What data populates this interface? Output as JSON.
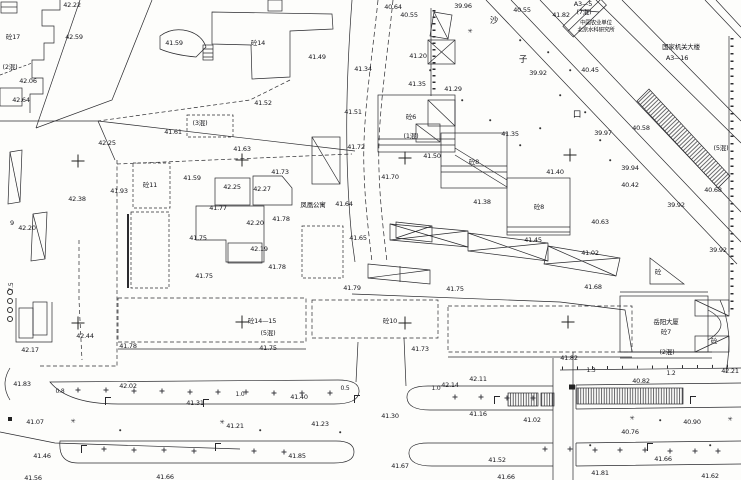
{
  "map": {
    "type": "cadastral-survey-site-plan",
    "colors": {
      "background": "#fdfdfb",
      "line": "#2a2a2e",
      "text": "#17171c"
    },
    "road_name_chars": [
      {
        "t": "沙",
        "x": 494,
        "y": 21
      },
      {
        "t": "子",
        "x": 523,
        "y": 60
      },
      {
        "t": "口",
        "x": 577,
        "y": 115
      }
    ],
    "place_labels": [
      {
        "t": "中国农业单位",
        "x": 596,
        "y": 24,
        "s": 5.5
      },
      {
        "t": "北京水科研究所",
        "x": 596,
        "y": 31,
        "s": 5.5
      },
      {
        "t": "国家机关大楼",
        "x": 681,
        "y": 47
      },
      {
        "t": "A3—16",
        "x": 677,
        "y": 58
      },
      {
        "t": "凤凰公寓",
        "x": 313,
        "y": 205
      },
      {
        "t": "岳阳大厦",
        "x": 666,
        "y": 322
      }
    ],
    "building_labels": [
      {
        "t": "砼17",
        "x": 13,
        "y": 37
      },
      {
        "t": "砼14",
        "x": 258,
        "y": 43
      },
      {
        "t": "A3—5",
        "x": 583,
        "y": 4
      },
      {
        "t": "(7混)",
        "x": 584,
        "y": 12
      },
      {
        "t": "(2混)",
        "x": 10,
        "y": 67
      },
      {
        "t": "(3混)",
        "x": 200,
        "y": 123
      },
      {
        "t": "砼6",
        "x": 411,
        "y": 117
      },
      {
        "t": "(1混)",
        "x": 411,
        "y": 136
      },
      {
        "t": "砼8",
        "x": 474,
        "y": 162
      },
      {
        "t": "砼8",
        "x": 539,
        "y": 207
      },
      {
        "t": "砼11",
        "x": 150,
        "y": 185
      },
      {
        "t": "(5混)",
        "x": 721,
        "y": 148
      },
      {
        "t": "砼14—15",
        "x": 262,
        "y": 321
      },
      {
        "t": "(5混)",
        "x": 268,
        "y": 333
      },
      {
        "t": "砼10",
        "x": 390,
        "y": 321
      },
      {
        "t": "砼7",
        "x": 666,
        "y": 332
      },
      {
        "t": "(2混)",
        "x": 667,
        "y": 352
      },
      {
        "t": "砼",
        "x": 658,
        "y": 272
      },
      {
        "t": "砼",
        "x": 714,
        "y": 341
      },
      {
        "t": "9",
        "x": 12,
        "y": 223
      }
    ],
    "dimension_labels": [
      {
        "t": "0.8",
        "x": 60,
        "y": 392
      },
      {
        "t": "1.0",
        "x": 240,
        "y": 395
      },
      {
        "t": "0.5",
        "x": 345,
        "y": 389
      },
      {
        "t": "1.0",
        "x": 436,
        "y": 389
      },
      {
        "t": "1.3",
        "x": 591,
        "y": 371
      },
      {
        "t": "1.2",
        "x": 671,
        "y": 374
      },
      {
        "t": "7.5",
        "x": 12,
        "y": 287,
        "rot": -90
      }
    ],
    "elevation_labels": [
      {
        "t": "42.22",
        "x": 72,
        "y": 5
      },
      {
        "t": "40.64",
        "x": 393,
        "y": 7
      },
      {
        "t": "39.96",
        "x": 463,
        "y": 6
      },
      {
        "t": "40.55",
        "x": 409,
        "y": 15
      },
      {
        "t": "40.55",
        "x": 522,
        "y": 10
      },
      {
        "t": "41.82",
        "x": 561,
        "y": 15
      },
      {
        "t": "42.59",
        "x": 74,
        "y": 37
      },
      {
        "t": "41.59",
        "x": 174,
        "y": 43
      },
      {
        "t": "41.49",
        "x": 317,
        "y": 57
      },
      {
        "t": "41.20",
        "x": 418,
        "y": 56
      },
      {
        "t": "39.92",
        "x": 538,
        "y": 73
      },
      {
        "t": "40.45",
        "x": 590,
        "y": 70
      },
      {
        "t": "41.34",
        "x": 363,
        "y": 69
      },
      {
        "t": "42.06",
        "x": 28,
        "y": 81
      },
      {
        "t": "41.35",
        "x": 417,
        "y": 84
      },
      {
        "t": "41.29",
        "x": 453,
        "y": 89
      },
      {
        "t": "42.64",
        "x": 21,
        "y": 100
      },
      {
        "t": "41.52",
        "x": 263,
        "y": 103
      },
      {
        "t": "41.51",
        "x": 353,
        "y": 112
      },
      {
        "t": "41.35",
        "x": 510,
        "y": 134
      },
      {
        "t": "40.58",
        "x": 641,
        "y": 128
      },
      {
        "t": "39.97",
        "x": 603,
        "y": 133
      },
      {
        "t": "41.61",
        "x": 173,
        "y": 132
      },
      {
        "t": "42.25",
        "x": 107,
        "y": 143
      },
      {
        "t": "41.72",
        "x": 356,
        "y": 147
      },
      {
        "t": "41.50",
        "x": 432,
        "y": 156
      },
      {
        "t": "41.63",
        "x": 242,
        "y": 149
      },
      {
        "t": "41.40",
        "x": 555,
        "y": 172
      },
      {
        "t": "41.59",
        "x": 192,
        "y": 178
      },
      {
        "t": "42.25",
        "x": 232,
        "y": 187
      },
      {
        "t": "42.27",
        "x": 262,
        "y": 189
      },
      {
        "t": "41.73",
        "x": 280,
        "y": 172
      },
      {
        "t": "41.70",
        "x": 390,
        "y": 177
      },
      {
        "t": "39.94",
        "x": 630,
        "y": 168
      },
      {
        "t": "40.42",
        "x": 630,
        "y": 185
      },
      {
        "t": "40.68",
        "x": 713,
        "y": 190
      },
      {
        "t": "39.92",
        "x": 676,
        "y": 205
      },
      {
        "t": "41.93",
        "x": 119,
        "y": 191
      },
      {
        "t": "41.77",
        "x": 218,
        "y": 208
      },
      {
        "t": "42.20",
        "x": 255,
        "y": 223
      },
      {
        "t": "41.78",
        "x": 281,
        "y": 219
      },
      {
        "t": "42.38",
        "x": 77,
        "y": 199
      },
      {
        "t": "41.64",
        "x": 344,
        "y": 204
      },
      {
        "t": "41.38",
        "x": 482,
        "y": 202
      },
      {
        "t": "40.63",
        "x": 600,
        "y": 222
      },
      {
        "t": "42.20",
        "x": 27,
        "y": 228
      },
      {
        "t": "41.75",
        "x": 198,
        "y": 238
      },
      {
        "t": "41.65",
        "x": 358,
        "y": 238
      },
      {
        "t": "41.45",
        "x": 533,
        "y": 240
      },
      {
        "t": "42.19",
        "x": 259,
        "y": 249
      },
      {
        "t": "41.78",
        "x": 277,
        "y": 267
      },
      {
        "t": "39.92",
        "x": 718,
        "y": 250
      },
      {
        "t": "41.02",
        "x": 590,
        "y": 253
      },
      {
        "t": "41.75",
        "x": 204,
        "y": 276
      },
      {
        "t": "41.79",
        "x": 352,
        "y": 288
      },
      {
        "t": "41.75",
        "x": 455,
        "y": 289
      },
      {
        "t": "41.68",
        "x": 593,
        "y": 287
      },
      {
        "t": "41.75",
        "x": 268,
        "y": 348
      },
      {
        "t": "41.73",
        "x": 420,
        "y": 349
      },
      {
        "t": "41.82",
        "x": 569,
        "y": 358
      },
      {
        "t": "42.17",
        "x": 30,
        "y": 350
      },
      {
        "t": "42.44",
        "x": 85,
        "y": 336
      },
      {
        "t": "41.78",
        "x": 128,
        "y": 346
      },
      {
        "t": "41.83",
        "x": 22,
        "y": 384
      },
      {
        "t": "42.02",
        "x": 128,
        "y": 386
      },
      {
        "t": "42.14",
        "x": 450,
        "y": 385
      },
      {
        "t": "42.11",
        "x": 478,
        "y": 379
      },
      {
        "t": "42.21",
        "x": 730,
        "y": 371
      },
      {
        "t": "40.82",
        "x": 641,
        "y": 381
      },
      {
        "t": "41.31",
        "x": 195,
        "y": 403
      },
      {
        "t": "41.40",
        "x": 299,
        "y": 397
      },
      {
        "t": "41.30",
        "x": 390,
        "y": 416
      },
      {
        "t": "41.07",
        "x": 35,
        "y": 422
      },
      {
        "t": "41.21",
        "x": 235,
        "y": 426
      },
      {
        "t": "41.23",
        "x": 320,
        "y": 424
      },
      {
        "t": "41.16",
        "x": 478,
        "y": 414
      },
      {
        "t": "41.02",
        "x": 532,
        "y": 420
      },
      {
        "t": "40.90",
        "x": 692,
        "y": 422
      },
      {
        "t": "40.76",
        "x": 630,
        "y": 432
      },
      {
        "t": "41.46",
        "x": 42,
        "y": 456
      },
      {
        "t": "41.52",
        "x": 497,
        "y": 460
      },
      {
        "t": "41.66",
        "x": 663,
        "y": 459
      },
      {
        "t": "41.85",
        "x": 297,
        "y": 456
      },
      {
        "t": "41.67",
        "x": 400,
        "y": 466
      },
      {
        "t": "41.56",
        "x": 33,
        "y": 478
      },
      {
        "t": "41.66",
        "x": 165,
        "y": 477
      },
      {
        "t": "41.66",
        "x": 506,
        "y": 477
      },
      {
        "t": "41.81",
        "x": 600,
        "y": 473
      },
      {
        "t": "41.62",
        "x": 710,
        "y": 476
      }
    ],
    "grid_crosses": [
      {
        "x": 78,
        "y": 161
      },
      {
        "x": 242,
        "y": 160
      },
      {
        "x": 405,
        "y": 158
      },
      {
        "x": 570,
        "y": 155
      },
      {
        "x": 78,
        "y": 323
      },
      {
        "x": 242,
        "y": 322
      },
      {
        "x": 405,
        "y": 323
      },
      {
        "x": 568,
        "y": 322
      }
    ],
    "symbols": {
      "lamps": [
        {
          "x": 108,
          "y": 401
        },
        {
          "x": 206,
          "y": 403
        },
        {
          "x": 357,
          "y": 399
        },
        {
          "x": 497,
          "y": 400
        },
        {
          "x": 693,
          "y": 400
        },
        {
          "x": 84,
          "y": 449
        },
        {
          "x": 218,
          "y": 447
        },
        {
          "x": 650,
          "y": 447
        }
      ],
      "tree_plus": [
        {
          "x": 78,
          "y": 390
        },
        {
          "x": 106,
          "y": 390
        },
        {
          "x": 134,
          "y": 391
        },
        {
          "x": 162,
          "y": 391
        },
        {
          "x": 190,
          "y": 392
        },
        {
          "x": 218,
          "y": 392
        },
        {
          "x": 246,
          "y": 392
        },
        {
          "x": 274,
          "y": 393
        },
        {
          "x": 302,
          "y": 393
        },
        {
          "x": 330,
          "y": 393
        },
        {
          "x": 455,
          "y": 397
        },
        {
          "x": 481,
          "y": 397
        },
        {
          "x": 507,
          "y": 398
        },
        {
          "x": 533,
          "y": 398
        },
        {
          "x": 104,
          "y": 449
        },
        {
          "x": 134,
          "y": 450
        },
        {
          "x": 164,
          "y": 450
        },
        {
          "x": 194,
          "y": 451
        },
        {
          "x": 254,
          "y": 451
        },
        {
          "x": 284,
          "y": 452
        },
        {
          "x": 545,
          "y": 449
        },
        {
          "x": 570,
          "y": 449
        },
        {
          "x": 595,
          "y": 450
        },
        {
          "x": 620,
          "y": 450
        },
        {
          "x": 645,
          "y": 450
        },
        {
          "x": 670,
          "y": 451
        },
        {
          "x": 695,
          "y": 451
        },
        {
          "x": 718,
          "y": 451
        }
      ],
      "tree_star": [
        {
          "x": 73,
          "y": 422
        },
        {
          "x": 222,
          "y": 423
        },
        {
          "x": 632,
          "y": 419
        },
        {
          "x": 730,
          "y": 420
        },
        {
          "x": 470,
          "y": 32
        }
      ],
      "dots": [
        {
          "x": 560,
          "y": 95
        },
        {
          "x": 585,
          "y": 112
        },
        {
          "x": 540,
          "y": 128
        },
        {
          "x": 600,
          "y": 140
        },
        {
          "x": 570,
          "y": 70
        },
        {
          "x": 610,
          "y": 160
        },
        {
          "x": 520,
          "y": 40
        },
        {
          "x": 548,
          "y": 52
        },
        {
          "x": 430,
          "y": 70
        },
        {
          "x": 462,
          "y": 100
        },
        {
          "x": 490,
          "y": 120
        },
        {
          "x": 520,
          "y": 145
        },
        {
          "x": 120,
          "y": 430
        },
        {
          "x": 260,
          "y": 430
        },
        {
          "x": 340,
          "y": 432
        },
        {
          "x": 590,
          "y": 445
        },
        {
          "x": 710,
          "y": 445
        },
        {
          "x": 660,
          "y": 420
        }
      ],
      "circles": [
        {
          "x": 10,
          "y": 292
        },
        {
          "x": 10,
          "y": 301
        },
        {
          "x": 10,
          "y": 310
        },
        {
          "x": 10,
          "y": 319
        }
      ],
      "blocks": [
        {
          "x": 10,
          "y": 419,
          "w": 4,
          "h": 4
        },
        {
          "x": 572,
          "y": 387,
          "w": 6,
          "h": 5
        }
      ]
    }
  }
}
